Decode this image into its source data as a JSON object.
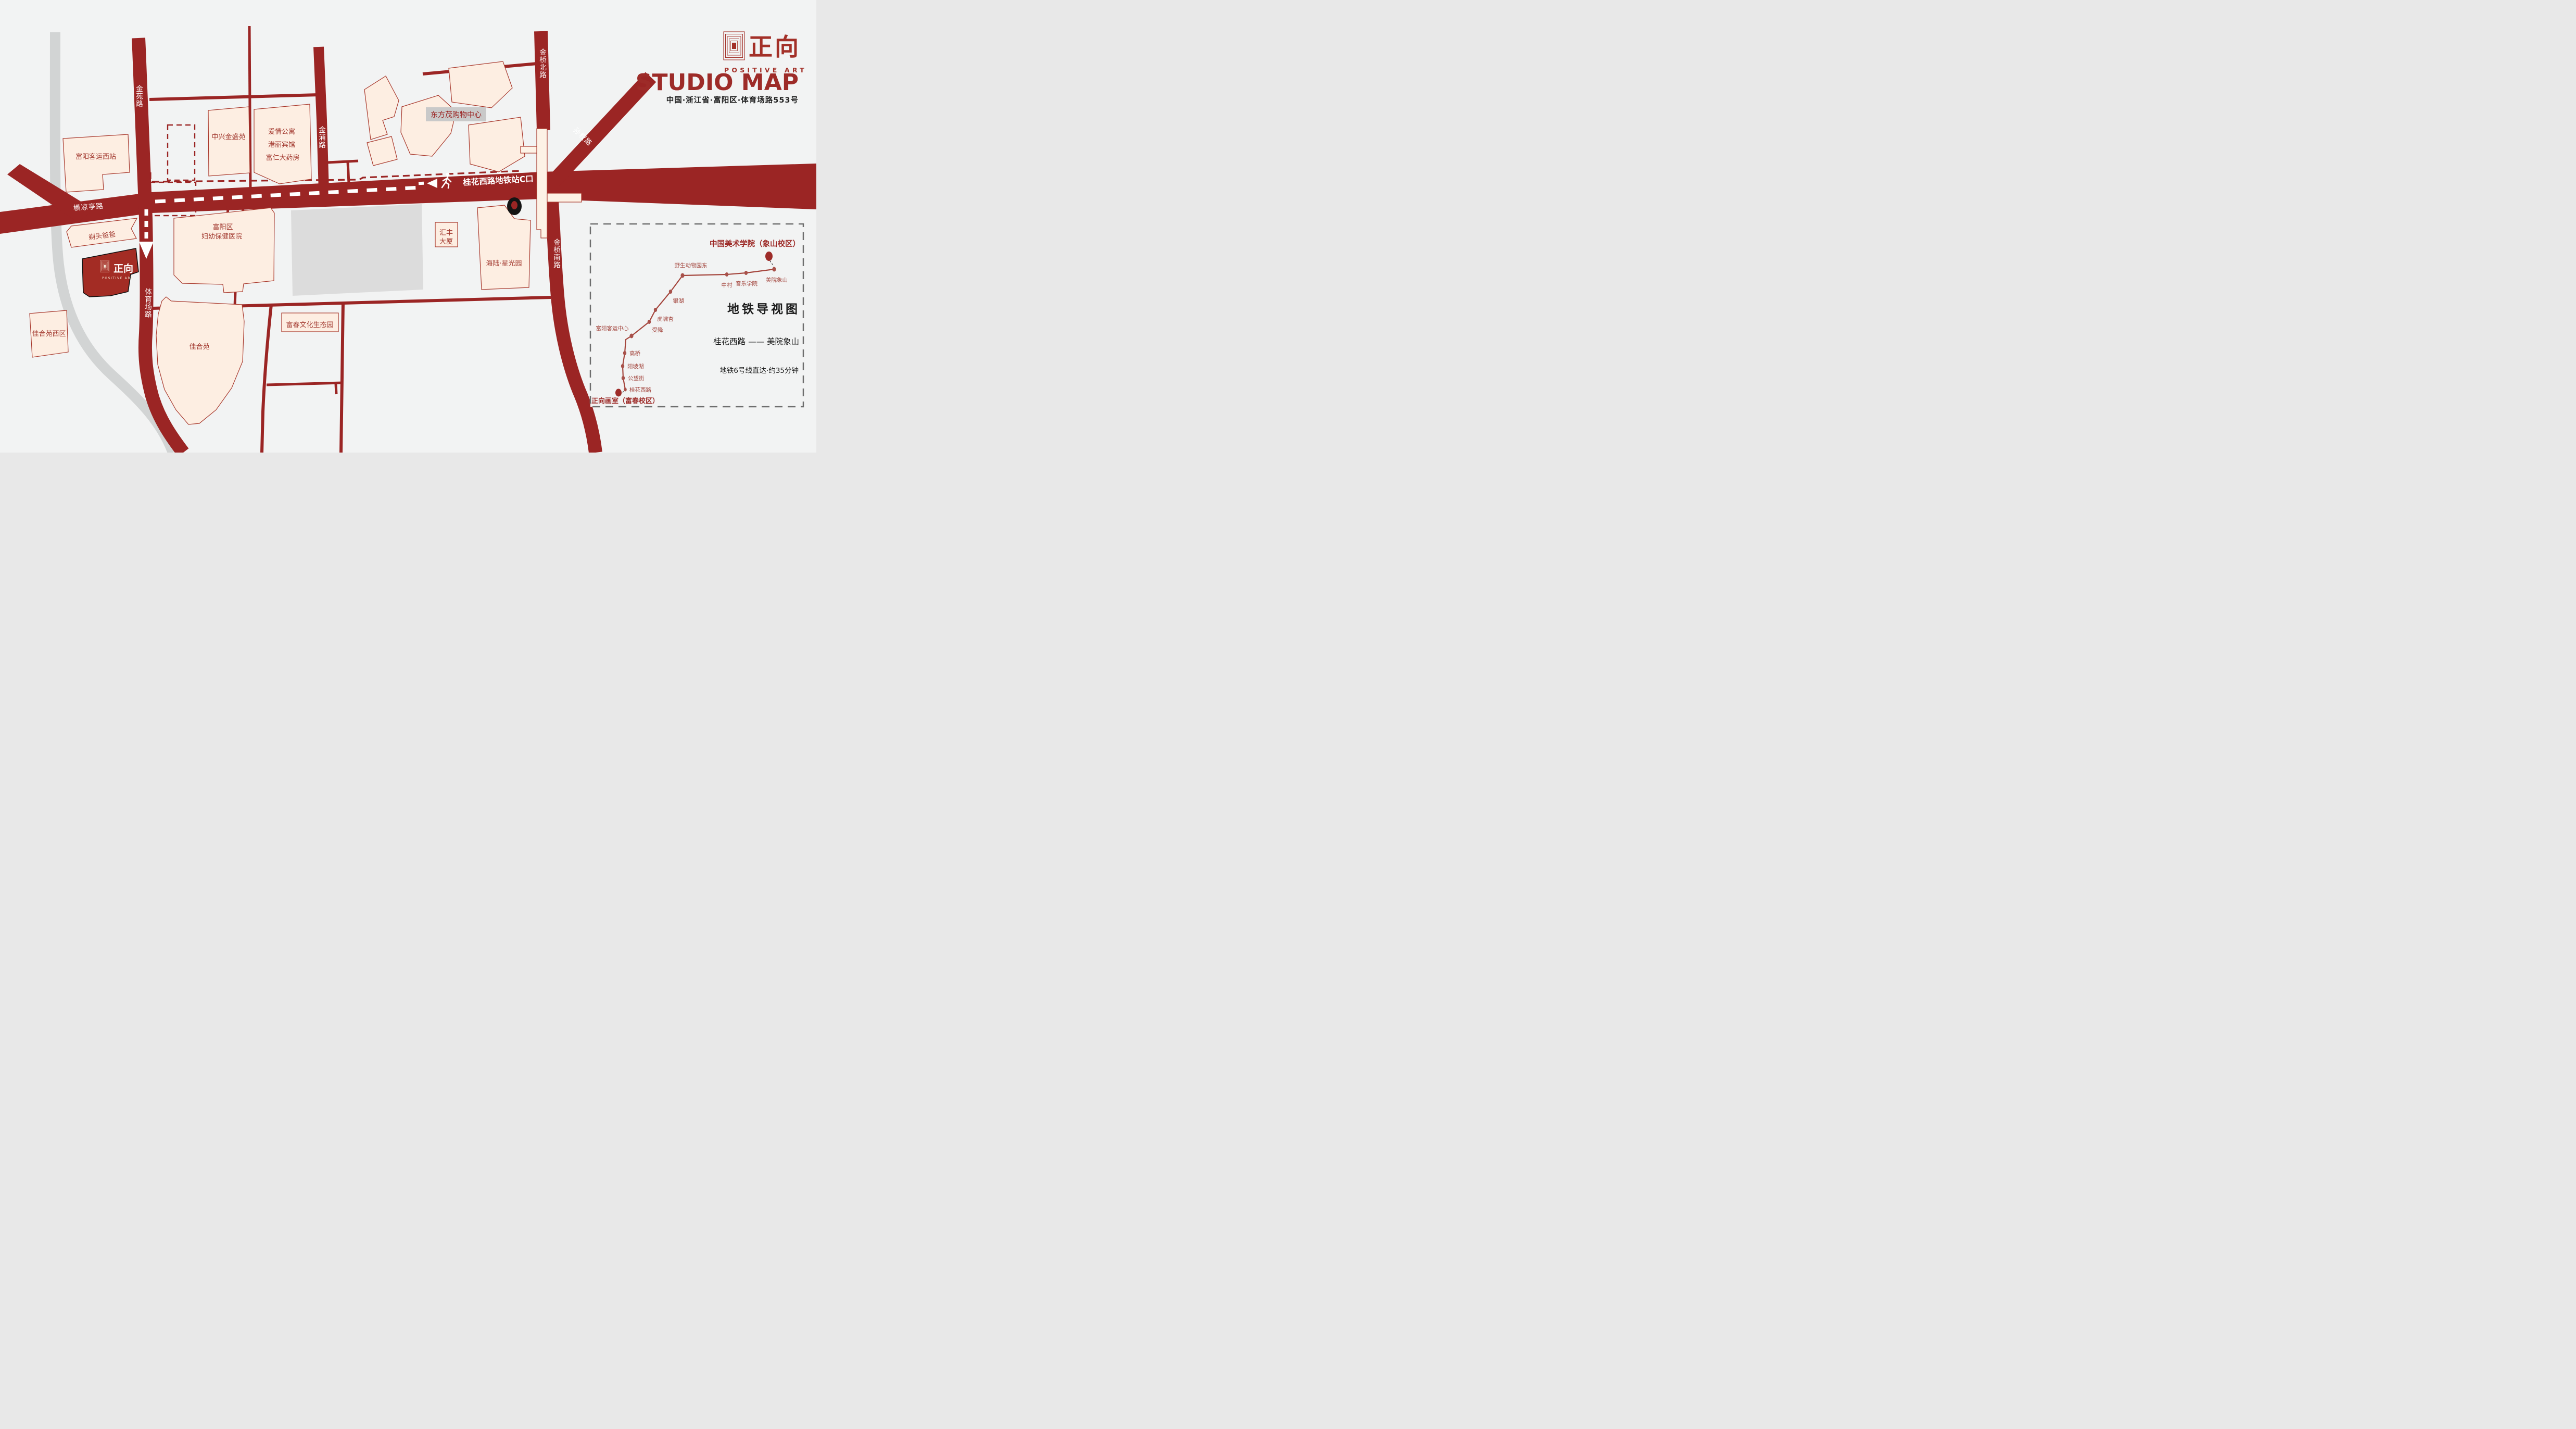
{
  "page": {
    "logo_zh": "正向",
    "logo_en": "POSITIVE ART",
    "heading": "STUDIO MAP",
    "address": "中国·浙江省·富阳区·体育场路553号"
  },
  "roads": {
    "jinyuan": "金苑路",
    "jinpu": "金浦路",
    "jinqiao_north": "金桥北路",
    "jinqiao_south": "金桥南路",
    "sunquan": "孙权路",
    "hengliangting": "横凉亭路",
    "tiyuchang": "体育场路"
  },
  "route": {
    "metro_exit_label": "桂花西路地铁站C口",
    "icons": [
      "walk-icon",
      "arrow-left-icon",
      "metro-exit-dot"
    ]
  },
  "buildings": {
    "keyun_west": "富阳客运西站",
    "zhongxing": "中兴金盛苑",
    "aiqing": "爱情公寓",
    "gangli": "港丽宾馆",
    "furen": "富仁大药房",
    "dongfangmao": "东方茂购物中心",
    "huifeng_l1": "汇丰",
    "huifeng_l2": "大厦",
    "hailu": "海陆·星光园",
    "hospital_l1": "富阳区",
    "hospital_l2": "妇幼保健医院",
    "titou": "剃头爸爸",
    "jiaheyuan_west": "佳合苑西区",
    "jiaheyuan": "佳合苑",
    "shengtaiyuan": "富春文化生态园"
  },
  "inset": {
    "title": "中国美术学院（象山校区）",
    "origin": "正向画室（富春校区）",
    "legend_title": "地铁导视图",
    "legend_route": "桂花西路 —— 美院象山",
    "legend_note": "地铁6号线直达·约35分钟",
    "stations": [
      {
        "name": "桂花西路"
      },
      {
        "name": "公望街"
      },
      {
        "name": "阳坡湖"
      },
      {
        "name": "高桥"
      },
      {
        "name": "富阳客运中心"
      },
      {
        "name": "受降"
      },
      {
        "name": "虎啸杏"
      },
      {
        "name": "银湖"
      },
      {
        "name": "野生动物园东"
      },
      {
        "name": "中村"
      },
      {
        "name": "音乐学院"
      },
      {
        "name": "美院象山"
      }
    ]
  }
}
